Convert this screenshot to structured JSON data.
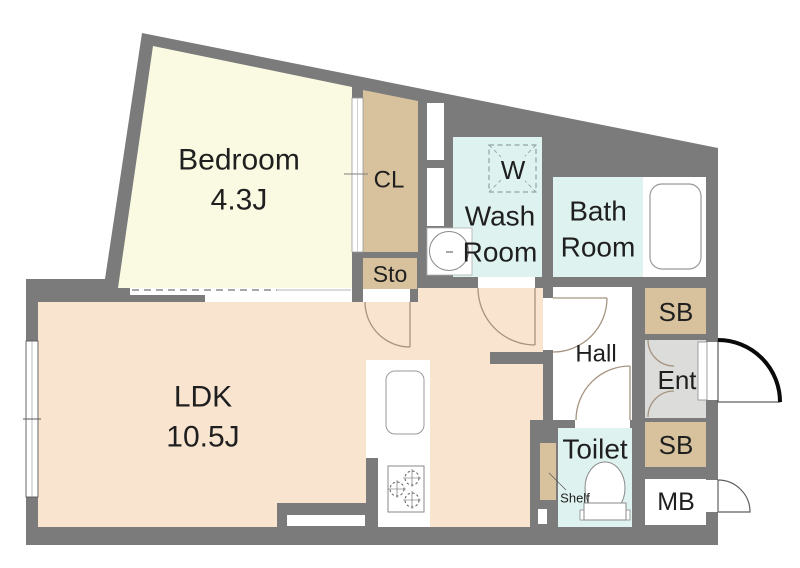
{
  "floorplan": {
    "rooms": {
      "bedroom": {
        "label": "Bedroom",
        "size": "4.3J"
      },
      "ldk": {
        "label": "LDK",
        "size": "10.5J"
      },
      "closet": {
        "label": "CL"
      },
      "storage": {
        "label": "Sto"
      },
      "washroom": {
        "line1": "Wash",
        "line2": "Room"
      },
      "washing_machine": {
        "label": "W"
      },
      "bathroom": {
        "line1": "Bath",
        "line2": "Room"
      },
      "hall": {
        "label": "Hall"
      },
      "entrance": {
        "label": "Ent"
      },
      "shoebox_upper": {
        "label": "SB"
      },
      "shoebox_lower": {
        "label": "SB"
      },
      "meter_box": {
        "label": "MB"
      },
      "toilet": {
        "label": "Toilet"
      },
      "shelf": {
        "label": "Shelf"
      }
    },
    "colors": {
      "wall": "#7b7b7b",
      "bedroom_floor": "#fafae2",
      "ldk_floor": "#f9e4d0",
      "storage_tan": "#d7c29d",
      "wet_area": "#def2ef",
      "entrance_floor": "#dcdcda",
      "white": "#ffffff",
      "label_text": "#1f1f1f",
      "door_swing": "#a5947f"
    }
  }
}
